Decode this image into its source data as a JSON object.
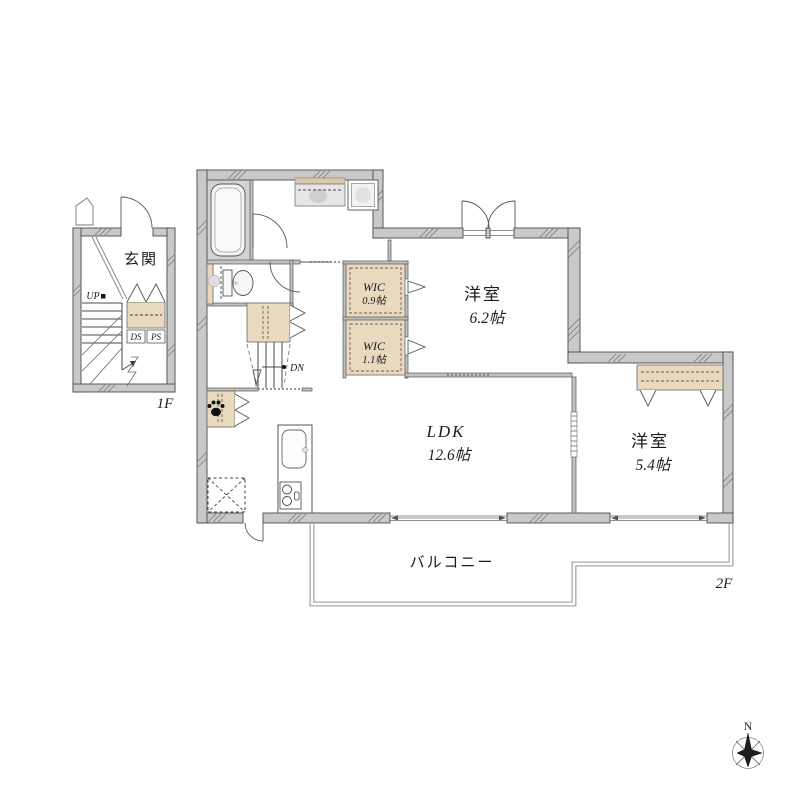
{
  "floors": {
    "first": "1F",
    "second": "2F"
  },
  "rooms": {
    "entrance": {
      "label": "玄関"
    },
    "bedroom1": {
      "label": "洋室",
      "area": "6.2帖"
    },
    "bedroom2": {
      "label": "洋室",
      "area": "5.4帖"
    },
    "ldk": {
      "label": "LDK",
      "area": "12.6帖"
    },
    "wic1": {
      "label": "WIC",
      "area": "0.9帖"
    },
    "wic2": {
      "label": "WIC",
      "area": "1.1帖"
    },
    "balcony": {
      "label": "バルコニー"
    }
  },
  "stairs": {
    "up": "UP",
    "down": "DN"
  },
  "ducts": {
    "ds": "DS",
    "ps": "PS"
  },
  "compass": {
    "north": "N"
  },
  "colors": {
    "wall_fill": "#c9c9c9",
    "closet_fill": "#e9d9bf",
    "bathroom_fill": "#d2d2d2",
    "line": "#4a4a4a"
  }
}
